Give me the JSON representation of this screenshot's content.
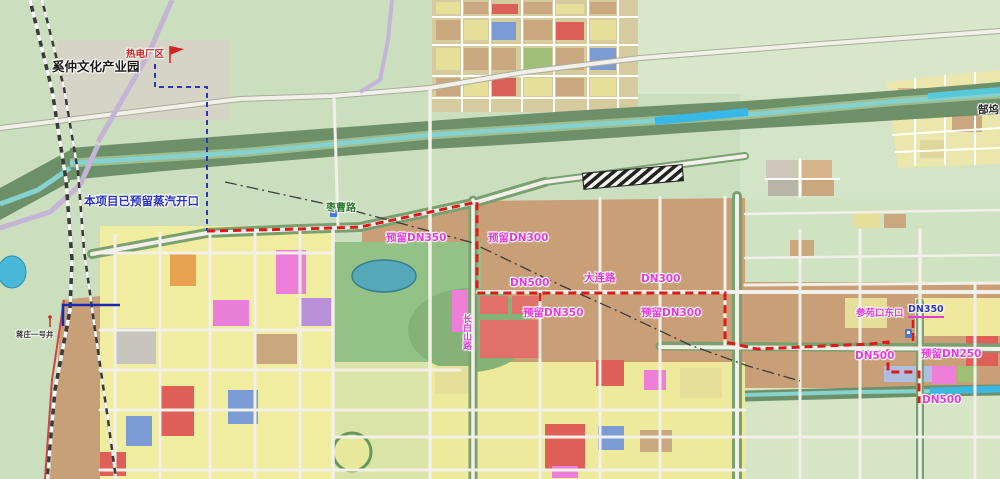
{
  "colors": {
    "pipeline_red": "#e11818",
    "reserved_blue": "#2a35c0",
    "label_magenta": "#e33ad8",
    "road_label_green": "#2a7a2a",
    "river_teal": "#86d2cf",
    "urban_tan": "#c99f78",
    "parcel_yellow": "#f0eca0",
    "park_green": "#93c186"
  },
  "map": {
    "labels": [
      {
        "id": "label-industry-park",
        "text": "奚仲文化产业园",
        "x": 52,
        "y": 61,
        "color": "#1a1a1a",
        "size": 12.5,
        "bold": true
      },
      {
        "id": "label-plant-area",
        "text": "热电厂区",
        "x": 126,
        "y": 50,
        "color": "#cc2020",
        "size": 9.5
      },
      {
        "id": "label-steam-opening",
        "text": "本项目已预留蒸汽开口",
        "x": 84,
        "y": 196,
        "color": "#2a35c0",
        "size": 11.5
      },
      {
        "id": "label-zaocao-road",
        "text": "枣曹路",
        "x": 326,
        "y": 204,
        "color": "#2a7a2a",
        "size": 10
      },
      {
        "id": "label-reserved-dn350-1",
        "text": "预留DN350",
        "x": 386,
        "y": 233,
        "color": "#e33ad8",
        "size": 10.5
      },
      {
        "id": "label-reserved-dn300-1",
        "text": "预留DN300",
        "x": 488,
        "y": 233,
        "color": "#e33ad8",
        "size": 10.5
      },
      {
        "id": "label-dn500-1",
        "text": "DN500",
        "x": 510,
        "y": 278,
        "color": "#e33ad8",
        "size": 10.5
      },
      {
        "id": "label-dalian-road",
        "text": "大连路",
        "x": 584,
        "y": 273,
        "color": "#e33ad8",
        "size": 10.5
      },
      {
        "id": "label-dn300",
        "text": "DN300",
        "x": 641,
        "y": 274,
        "color": "#e33ad8",
        "size": 10.5
      },
      {
        "id": "label-reserved-dn350-2",
        "text": "预留DN350",
        "x": 523,
        "y": 308,
        "color": "#e33ad8",
        "size": 10.5
      },
      {
        "id": "label-reserved-dn300-2",
        "text": "预留DN300",
        "x": 641,
        "y": 308,
        "color": "#e33ad8",
        "size": 10.5
      },
      {
        "id": "label-canyuankou",
        "text": "参苑口东口",
        "x": 856,
        "y": 309,
        "color": "#e33ad8",
        "size": 9.5
      },
      {
        "id": "label-dn350-branch",
        "text": "DN350",
        "x": 908,
        "y": 305,
        "color": "#2a35c0",
        "size": 9.5,
        "underline": "#e33ad8"
      },
      {
        "id": "label-dn500-2",
        "text": "DN500",
        "x": 855,
        "y": 351,
        "color": "#e33ad8",
        "size": 10.5
      },
      {
        "id": "label-reserved-dn250",
        "text": "预留DN250",
        "x": 921,
        "y": 349,
        "color": "#e33ad8",
        "size": 10.5
      },
      {
        "id": "label-dn500-3",
        "text": "DN500",
        "x": 922,
        "y": 395,
        "color": "#e33ad8",
        "size": 10.5
      },
      {
        "id": "label-gaowu-village",
        "text": "郜坞",
        "x": 978,
        "y": 105,
        "color": "#222222",
        "size": 10.5
      },
      {
        "id": "label-changbaishan-road",
        "text": "长白山路",
        "x": 461,
        "y": 314,
        "color": "#cc44cc",
        "size": 9,
        "vertical": true
      },
      {
        "id": "label-mine-well",
        "text": "蒋庄一号井",
        "x": 16,
        "y": 331,
        "color": "#333333",
        "size": 7.5
      }
    ]
  },
  "pipeline": {
    "source_line_points": "155,64 155,87 207,87 207,231",
    "main_route_points": "207,231 300,229 360,227 477,202 477,293 725,293 725,342 757,349 870,344 888,342 888,372 919,372 919,403",
    "branch_dn350_points": "913,341 913,318",
    "stub_dn350_points": "540,293 540,304",
    "reserved_blue_points": "120,305 63,305 63,326",
    "existing_dashdot_points": "225,182 340,207 470,242 560,285 620,312 690,345 748,366 800,381"
  }
}
